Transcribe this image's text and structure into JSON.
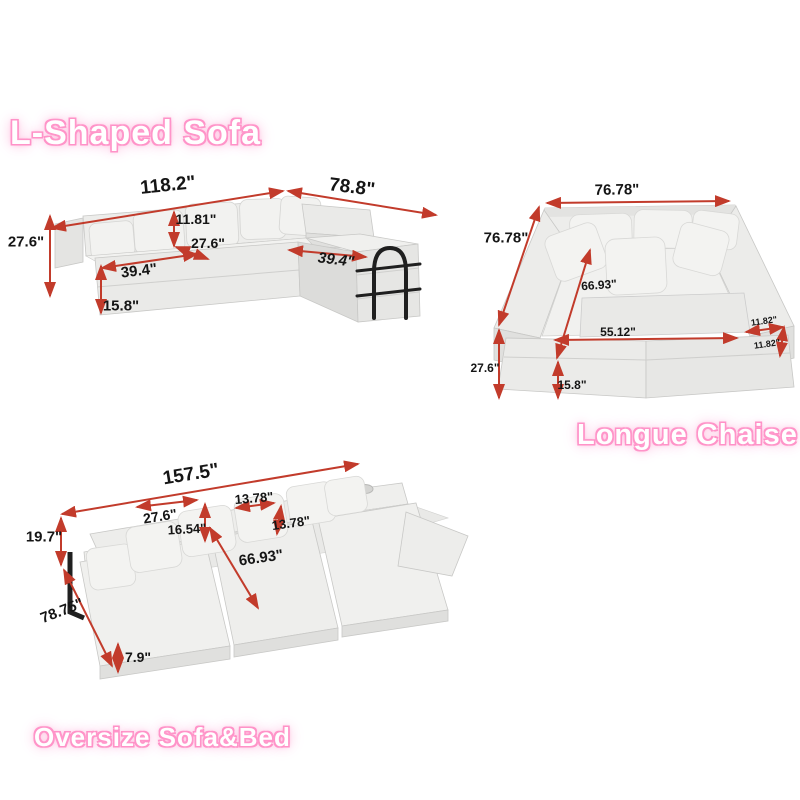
{
  "titles": {
    "l_shaped": "L-Shaped Sofa",
    "longue_chaise": "Longue Chaise",
    "oversize": "Oversize Sofa&Bed"
  },
  "l_shaped": {
    "total_width": "118.2\"",
    "chaise_length": "78.8\"",
    "overall_height": "27.6\"",
    "backrest_height": "11.81\"",
    "seat_depth": "27.6\"",
    "seat_width": "39.4\"",
    "chaise_width": "39.4\"",
    "base_height": "15.8\""
  },
  "longue_chaise": {
    "width": "76.78\"",
    "depth": "76.78\"",
    "inner_diagonal": "66.93\"",
    "inner_width": "55.12\"",
    "arm_width": "11.82\"",
    "arm_height": "11.82\"",
    "overall_height": "27.6\"",
    "base_height": "15.8\""
  },
  "oversize": {
    "total_width": "157.5\"",
    "back_height": "19.7\"",
    "cushion_width": "27.6\"",
    "cushion_height": "16.54\"",
    "pillow_width": "13.78\"",
    "pillow_height": "13.78\"",
    "bed_diagonal": "66.93\"",
    "total_depth": "78.75\"",
    "mattress_height": "7.9\""
  },
  "colors": {
    "dimension_arrow": "#c23b2b",
    "title_glow": "#ff8fc6",
    "sofa_fabric": "#efefed"
  }
}
